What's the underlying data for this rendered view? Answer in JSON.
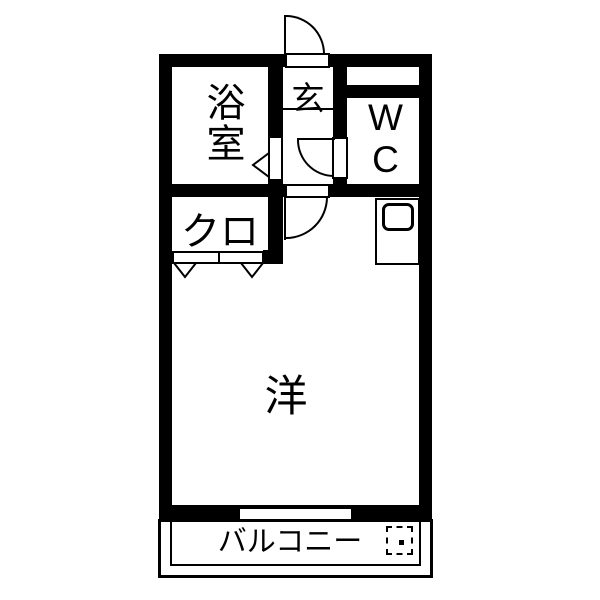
{
  "floorplan": {
    "type": "apartment-floor-plan",
    "colors": {
      "wall": "#000000",
      "floor": "#ffffff",
      "line": "#000000"
    },
    "rooms": {
      "bathroom": {
        "label": "浴室"
      },
      "entrance": {
        "label": "玄"
      },
      "wc": {
        "label": "WC"
      },
      "closet": {
        "label": "クロ"
      },
      "main": {
        "label": "洋"
      },
      "balcony": {
        "label": "バルコニー"
      }
    },
    "fixtures": {
      "washer_symbol": "dashed-square-with-center-dot",
      "kitchen_sink": "rounded-rect-outline",
      "doors": [
        "entrance-swing-door",
        "wc-swing-door",
        "main-room-swing-door",
        "bathroom-folding-door",
        "closet-folding-doors"
      ]
    }
  }
}
